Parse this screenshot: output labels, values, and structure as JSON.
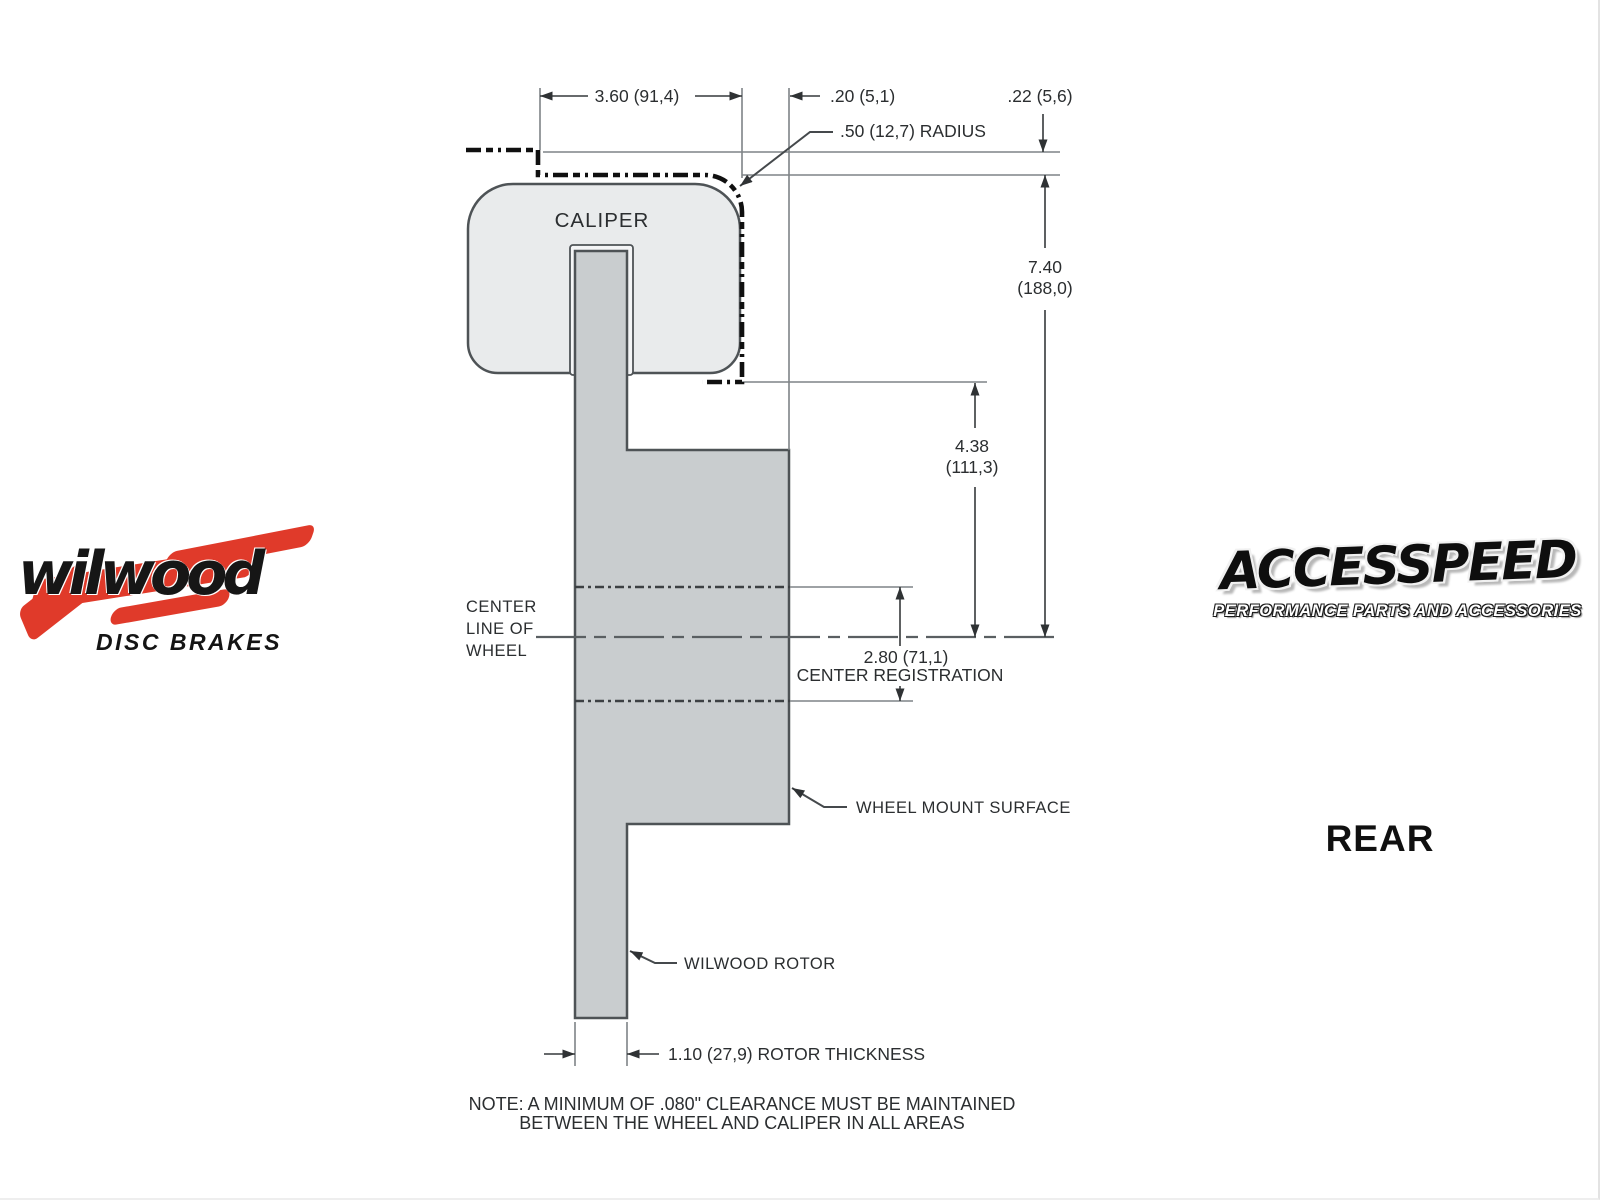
{
  "view_label": "REAR",
  "drawing": {
    "caliper_label": "CALIPER",
    "center_line_of_wheel": [
      "CENTER",
      "LINE OF",
      "WHEEL"
    ],
    "dims": {
      "caliper_width": "3.60 (91,4)",
      "caliper_to_mount": ".20 (5,1)",
      "wheel_clearance": ".22 (5,6)",
      "corner_radius": ".50 (12,7) RADIUS",
      "mount_to_centerline": [
        "7.40",
        "(188,0)"
      ],
      "caliper_bottom_to_centerline": [
        "4.38",
        "(111,3)"
      ],
      "center_registration_value": "2.80 (71,1)",
      "center_registration_label": "CENTER REGISTRATION",
      "rotor_thickness": "1.10 (27,9) ROTOR THICKNESS"
    },
    "callouts": {
      "wheel_mount_surface": "WHEEL MOUNT SURFACE",
      "wilwood_rotor": "WILWOOD ROTOR"
    },
    "note_line1": "NOTE: A MINIMUM OF .080\" CLEARANCE MUST BE MAINTAINED",
    "note_line2": "BETWEEN THE WHEEL AND CALIPER IN ALL AREAS",
    "colors": {
      "caliper_fill": "#e9ebec",
      "rotor_fill": "#c9cdcf",
      "outline": "#4e5356",
      "dimension_lines": "#35393b",
      "clearance_dash": "#101010",
      "thin_reference": "#7f8487"
    }
  },
  "branding": {
    "wilwood": {
      "name": "wilwood",
      "tagline": "DISC BRAKES",
      "accent_color": "#e03a2a"
    },
    "accesspeed": {
      "name": "ACCESSPEED",
      "tagline": "PERFORMANCE PARTS AND ACCESSORIES"
    }
  }
}
